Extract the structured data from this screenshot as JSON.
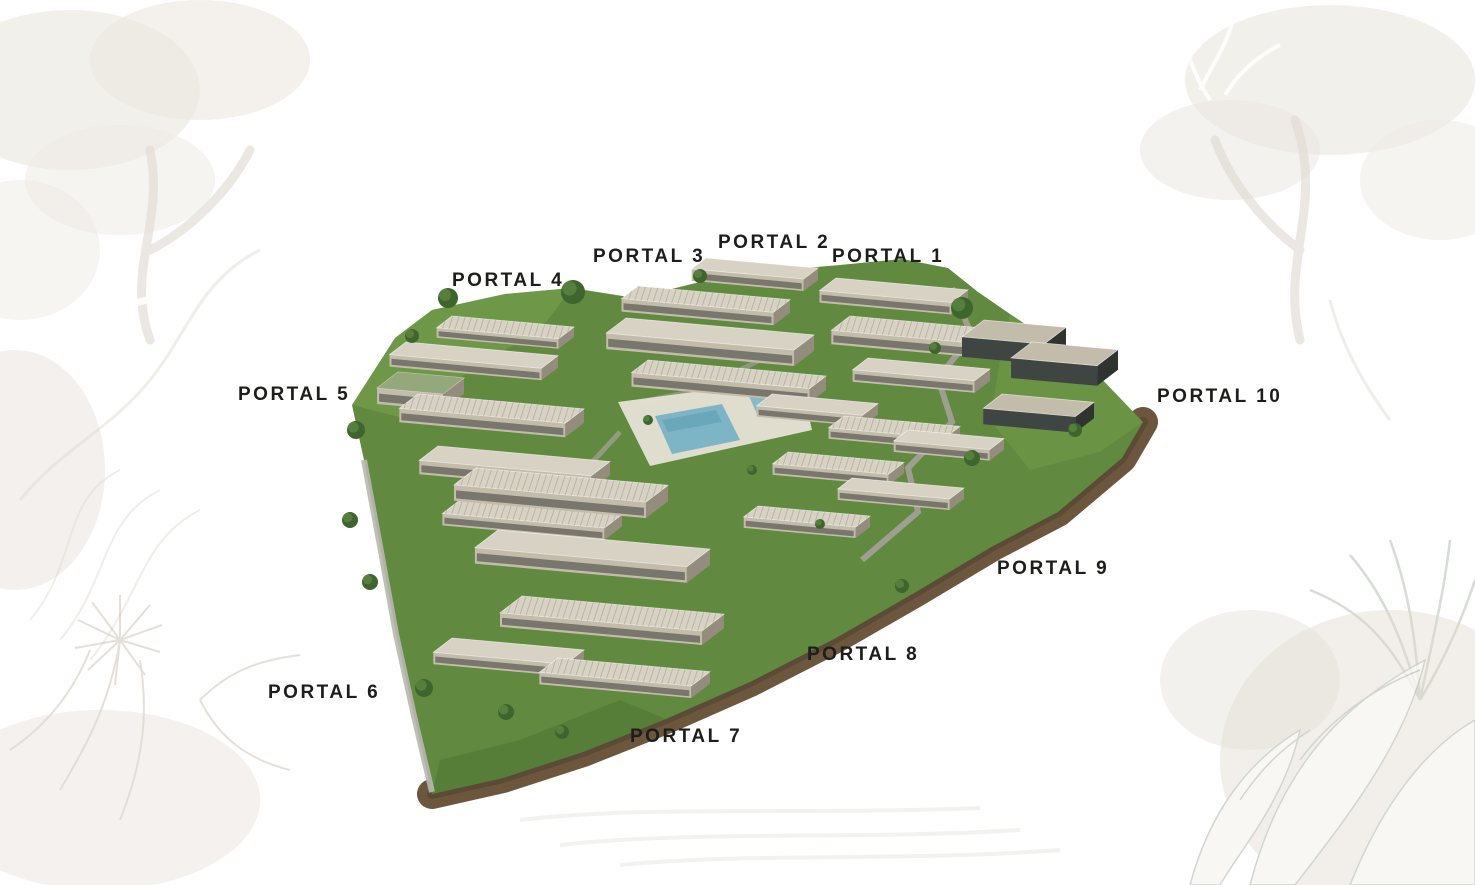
{
  "image": {
    "type": "architectural-masterplan-render",
    "description": "Aerial 3D rendering of a terraced residential complex of beige modern apartment blocks on a triangular landscaped plot with lawns, trees, a swimming pool and a brown perimeter retaining wall, surrounded by faint botanical line-art on a white background. Ten entrance portals are labeled around the plan.",
    "labels": [
      {
        "id": "portal-1",
        "text": "PORTAL 1"
      },
      {
        "id": "portal-2",
        "text": "PORTAL 2"
      },
      {
        "id": "portal-3",
        "text": "PORTAL 3"
      },
      {
        "id": "portal-4",
        "text": "PORTAL 4"
      },
      {
        "id": "portal-5",
        "text": "PORTAL 5"
      },
      {
        "id": "portal-6",
        "text": "PORTAL 6"
      },
      {
        "id": "portal-7",
        "text": "PORTAL 7"
      },
      {
        "id": "portal-8",
        "text": "PORTAL 8"
      },
      {
        "id": "portal-9",
        "text": "PORTAL 9"
      },
      {
        "id": "portal-10",
        "text": "PORTAL 10"
      }
    ],
    "colors": {
      "background": "#ffffff",
      "label_text": "#1d1d1b",
      "grass": "#61893f",
      "grass_light": "#7aa24e",
      "grass_dark": "#4d7434",
      "building_light": "#d8d2c4",
      "building_mid": "#c3bcab",
      "building_dark": "#948c7c",
      "building_glass": "#3f4542",
      "window_dark": "#3a3d3a",
      "roof_hatch": "#8f897a",
      "pool_water": "#7db5c6",
      "pool_deck": "#e6e1d5",
      "earth_wall": "#6c573e",
      "earth_wall_dark": "#584733",
      "path_gray": "#a5a29a",
      "tree_green": "#3e652e",
      "tree_green_light": "#5d8540",
      "botanical_beige": "#ddd5ca",
      "botanical_line": "#c9bfb2",
      "botanical_leaf_line": "#c6cdc5"
    }
  }
}
